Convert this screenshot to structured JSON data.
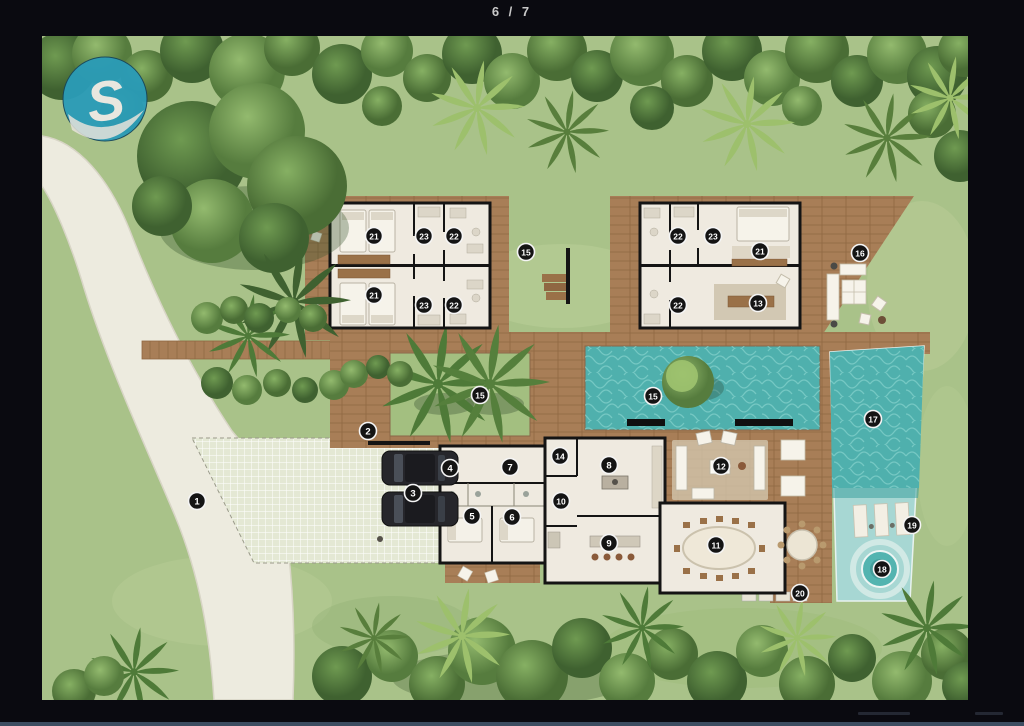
{
  "viewer": {
    "counter": "6 / 7",
    "background_color": "#0a0a10",
    "statusbar_color": "#3c4d61"
  },
  "plan": {
    "logo_letter": "S",
    "colors": {
      "logo": "#2a9cb8",
      "grass": "#a9c289",
      "grass_light": "#bccf99",
      "garden": "#a3bf80",
      "foliage_dark": "#4a6d35",
      "deck": "#a87e57",
      "deck_line": "#8f6742",
      "drive": "#edebdf",
      "court": "#e4e8d4",
      "water_dark": "#4fb0ad",
      "water_light": "#a7d7d3",
      "floor": "#efeae0",
      "wall": "#141414",
      "marker_bg": "#141414",
      "marker_ring": "#f5f5f5",
      "marker_text": "#ffffff"
    },
    "markers": [
      {
        "n": "1",
        "x": 155,
        "y": 465
      },
      {
        "n": "2",
        "x": 326,
        "y": 395
      },
      {
        "n": "3",
        "x": 371,
        "y": 457
      },
      {
        "n": "4",
        "x": 408,
        "y": 432
      },
      {
        "n": "5",
        "x": 430,
        "y": 480
      },
      {
        "n": "6",
        "x": 470,
        "y": 481
      },
      {
        "n": "7",
        "x": 468,
        "y": 431
      },
      {
        "n": "8",
        "x": 567,
        "y": 429
      },
      {
        "n": "9",
        "x": 567,
        "y": 507
      },
      {
        "n": "10",
        "x": 519,
        "y": 465
      },
      {
        "n": "11",
        "x": 674,
        "y": 509
      },
      {
        "n": "12",
        "x": 679,
        "y": 430
      },
      {
        "n": "13",
        "x": 716,
        "y": 267
      },
      {
        "n": "14",
        "x": 518,
        "y": 420
      },
      {
        "n": "15",
        "x": 484,
        "y": 216
      },
      {
        "n": "15",
        "x": 438,
        "y": 359
      },
      {
        "n": "15",
        "x": 611,
        "y": 360
      },
      {
        "n": "16",
        "x": 818,
        "y": 217
      },
      {
        "n": "17",
        "x": 831,
        "y": 383
      },
      {
        "n": "18",
        "x": 840,
        "y": 533
      },
      {
        "n": "19",
        "x": 870,
        "y": 489
      },
      {
        "n": "20",
        "x": 758,
        "y": 557
      },
      {
        "n": "21",
        "x": 332,
        "y": 200
      },
      {
        "n": "21",
        "x": 332,
        "y": 259
      },
      {
        "n": "21",
        "x": 718,
        "y": 215
      },
      {
        "n": "22",
        "x": 412,
        "y": 200
      },
      {
        "n": "22",
        "x": 412,
        "y": 269
      },
      {
        "n": "22",
        "x": 636,
        "y": 200
      },
      {
        "n": "22",
        "x": 636,
        "y": 269
      },
      {
        "n": "23",
        "x": 382,
        "y": 200
      },
      {
        "n": "23",
        "x": 382,
        "y": 269
      },
      {
        "n": "23",
        "x": 671,
        "y": 200
      }
    ]
  }
}
